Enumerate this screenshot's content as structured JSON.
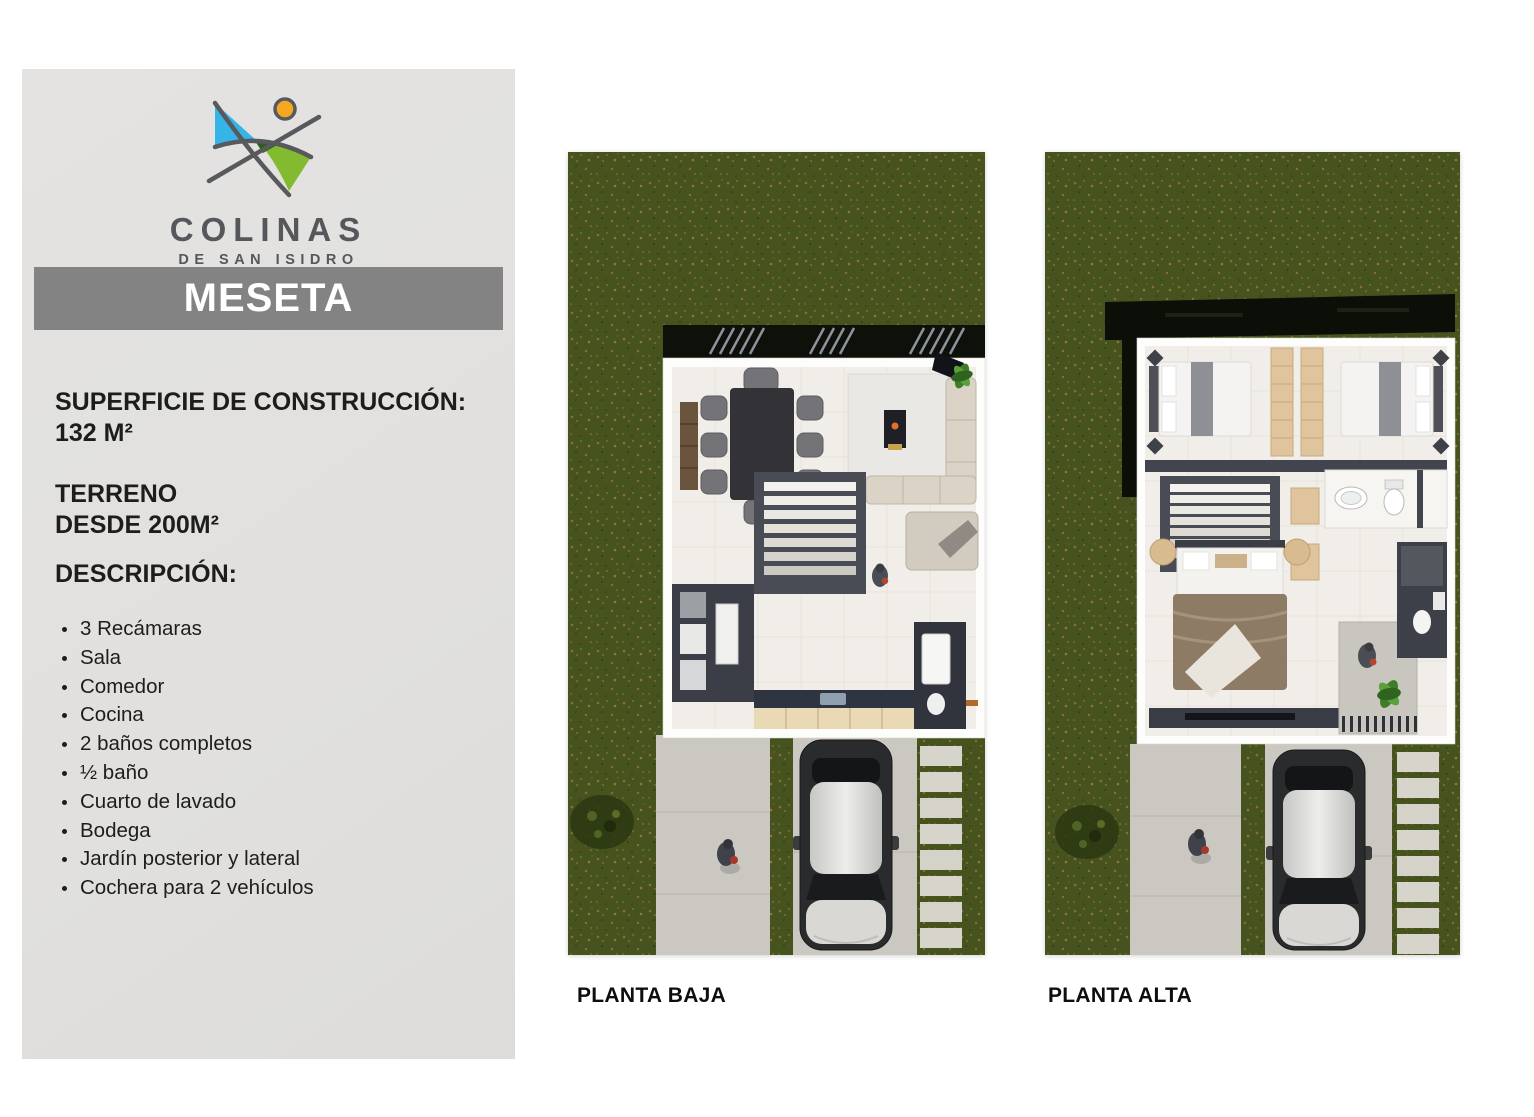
{
  "sidebar": {
    "logo": {
      "icon": "colinas-logo-icon",
      "brand": "COLINAS",
      "sub_brand": "DE SAN ISIDRO",
      "colors": {
        "blue": "#35b4e8",
        "green": "#82bb2f",
        "dark_green": "#2e5d1e",
        "orange": "#f5a623",
        "line_gray": "#57595d"
      }
    },
    "banner": {
      "title": "MESETA",
      "bg": "#838383",
      "text_color": "#ffffff"
    },
    "construction": {
      "label": "SUPERFICIE DE CONSTRUCCIÓN:",
      "value": "132 M²"
    },
    "terrain": {
      "label": "TERRENO",
      "value": "DESDE 200M²"
    },
    "description_heading": "DESCRIPCIÓN:",
    "features": [
      "3 Recámaras",
      "Sala",
      "Comedor",
      "Cocina",
      "2 baños completos",
      "½ baño",
      "Cuarto de lavado",
      "Bodega",
      "Jardín posterior y lateral",
      "Cochera para 2 vehículos"
    ]
  },
  "plans": [
    {
      "id": "planta-baja",
      "label": "PLANTA BAJA"
    },
    {
      "id": "planta-alta",
      "label": "PLANTA ALTA"
    }
  ],
  "palette": {
    "panel_gray": "#e2e1df",
    "banner_gray": "#838383",
    "grass_green": "#47531f",
    "grass_speckle": "#8a6d39",
    "concrete": "#cbc8c1",
    "floor_cream": "#f1eee9",
    "wall_charcoal": "#43454e",
    "roof_black": "#0d0f08"
  }
}
